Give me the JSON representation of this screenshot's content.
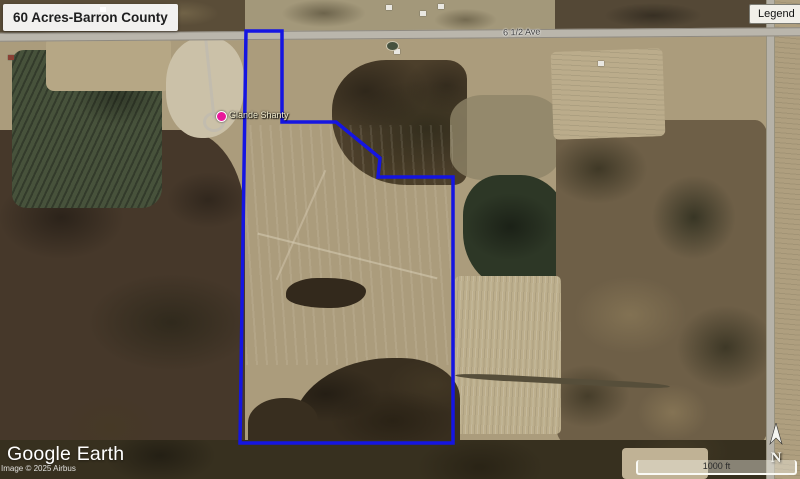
{
  "header": {
    "title": "60 Acres-Barron County",
    "legend_label": "Legend"
  },
  "map": {
    "road_label": "6 1/2 Ave",
    "placemark_label": "Glande Shanty",
    "pin_color": "#e8189a",
    "boundary_color": "#1515e2",
    "boundary_points": "246,31 282,31 282,122 336,122 380,158 378,177 453,177 453,443 240,443"
  },
  "footer": {
    "logo_text": "Google Earth",
    "attribution": "Image © 2025 Airbus",
    "scale_label": "1000 ft",
    "compass_label": "N"
  }
}
